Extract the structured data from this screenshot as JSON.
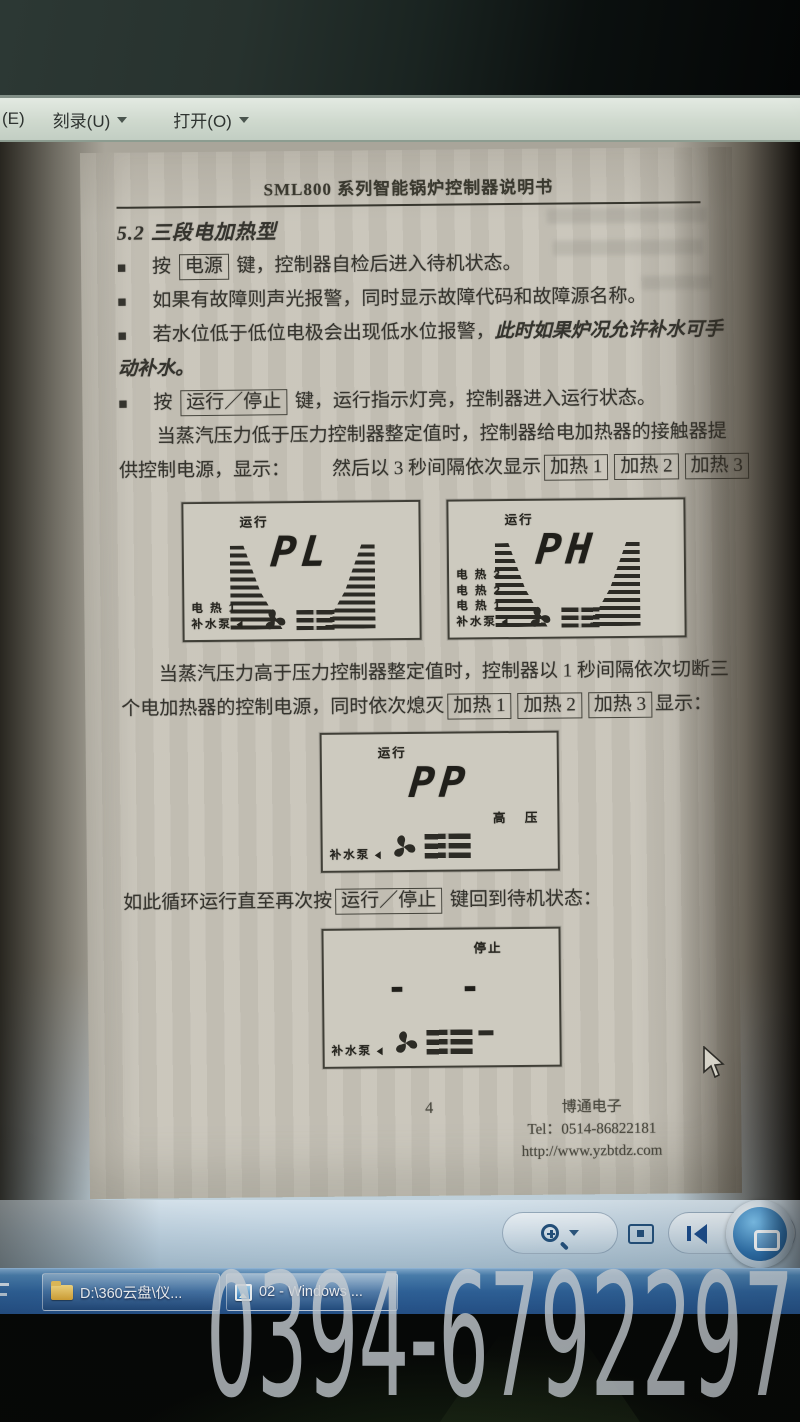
{
  "colors": {
    "paper": "#c8c4b9",
    "lcd_ink": "#26251f",
    "taskbar_blue": "#2f639b",
    "toolbar_blue": "#bdd0de",
    "menubar_green": "#cfd9ce",
    "watermark_gray": "#cbd2d8"
  },
  "menu_bar": {
    "partial_item": "(E)",
    "burn_item": "刻录(U)",
    "open_item": "打开(O)"
  },
  "document": {
    "header_title": "SML800 系列智能锅炉控制器说明书",
    "section_heading": "5.2 三段电加热型",
    "bullet_glyph": "■",
    "bullets": {
      "b1": {
        "pre": "按 ",
        "key": "电源",
        "post": " 键，控制器自检后进入待机状态。"
      },
      "b2": {
        "text": "如果有故障则声光报警，同时显示故障代码和故障源名称。"
      },
      "b3": {
        "text": "若水位低于低位电极会出现低水位报警，",
        "italic1": "此时如果炉况允许补水可手",
        "italic2": "动补水。"
      },
      "b4": {
        "pre": "按 ",
        "key": "运行／停止",
        "post": " 键，运行指示灯亮，控制器进入运行状态。"
      }
    },
    "para1": {
      "line1": "当蒸汽压力低于压力控制器整定值时，控制器给电加热器的接触器提",
      "line2_a": "供控制电源，显示：",
      "line2_b": "然后以 3 秒间隔依次显示"
    },
    "heat_keys": [
      "加热 1",
      "加热 2",
      "加热 3"
    ],
    "para2": {
      "line1": "当蒸汽压力高于压力控制器整定值时，控制器以 1 秒间隔依次切断三",
      "line2_a": "个电加热器的控制电源，同时依次熄灭",
      "line2_b": "显示："
    },
    "para3": {
      "pre": "如此循环运行直至再次按",
      "key": "运行／停止",
      "post": " 键回到待机状态："
    },
    "figures": [
      {
        "status": "运行",
        "main": "PL",
        "labels": [
          "电 热 1",
          "补水泵"
        ]
      },
      {
        "status": "运行",
        "main": "PH",
        "labels": [
          "电 热 3",
          "电 热 2",
          "电 热 1",
          "补水泵"
        ]
      },
      {
        "status": "运行",
        "main": "PP",
        "labels": [
          "补水泵"
        ],
        "side_label": "高 压"
      },
      {
        "status": "停止",
        "main": "- -",
        "labels": [
          "补水泵"
        ]
      }
    ],
    "footer": {
      "page_number": "4",
      "company": "博通电子",
      "tel": "Tel：0514-86822181",
      "url": "http://www.yzbtdz.com"
    }
  },
  "toolbar_icons": {
    "zoom": "magnifier-icon",
    "fit": "actual-size-icon",
    "previous": "previous-icon",
    "slideshow": "slideshow-icon"
  },
  "taskbar": {
    "buttons": [
      {
        "icon": "folder-icon",
        "label": "D:\\360云盘\\仪..."
      },
      {
        "icon": "photo-viewer-icon",
        "label": "02 - Windows ..."
      }
    ]
  },
  "watermark": {
    "text": "0394-6792297"
  }
}
